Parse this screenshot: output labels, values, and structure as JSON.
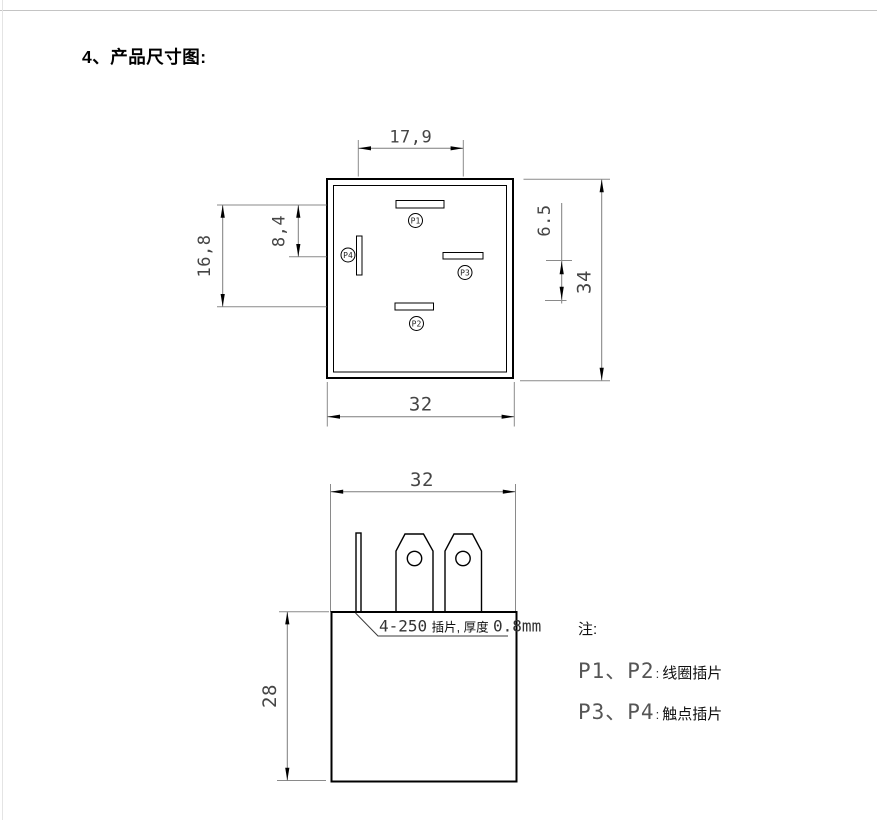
{
  "page": {
    "title": "4、产品尺寸图:"
  },
  "top_view": {
    "dims": {
      "width_top": "17,9",
      "left_outer": "16,8",
      "left_inner": "8,4",
      "right_inner": "6.5",
      "right_outer": "34",
      "bottom": "32"
    },
    "pins": {
      "p1": "P1",
      "p2": "P2",
      "p3": "P3",
      "p4": "P4"
    }
  },
  "bottom_view": {
    "dims": {
      "width": "32",
      "height": "28"
    },
    "leader": {
      "tab": "4-250",
      "tab_cn": "插片, 厚度",
      "thickness": "0.8mm"
    }
  },
  "notes": {
    "heading": "注:",
    "separator": ":",
    "items": [
      {
        "pins": "P1、P2",
        "label": "线圈插片"
      },
      {
        "pins": "P3、P4",
        "label": "触点插片"
      }
    ]
  }
}
